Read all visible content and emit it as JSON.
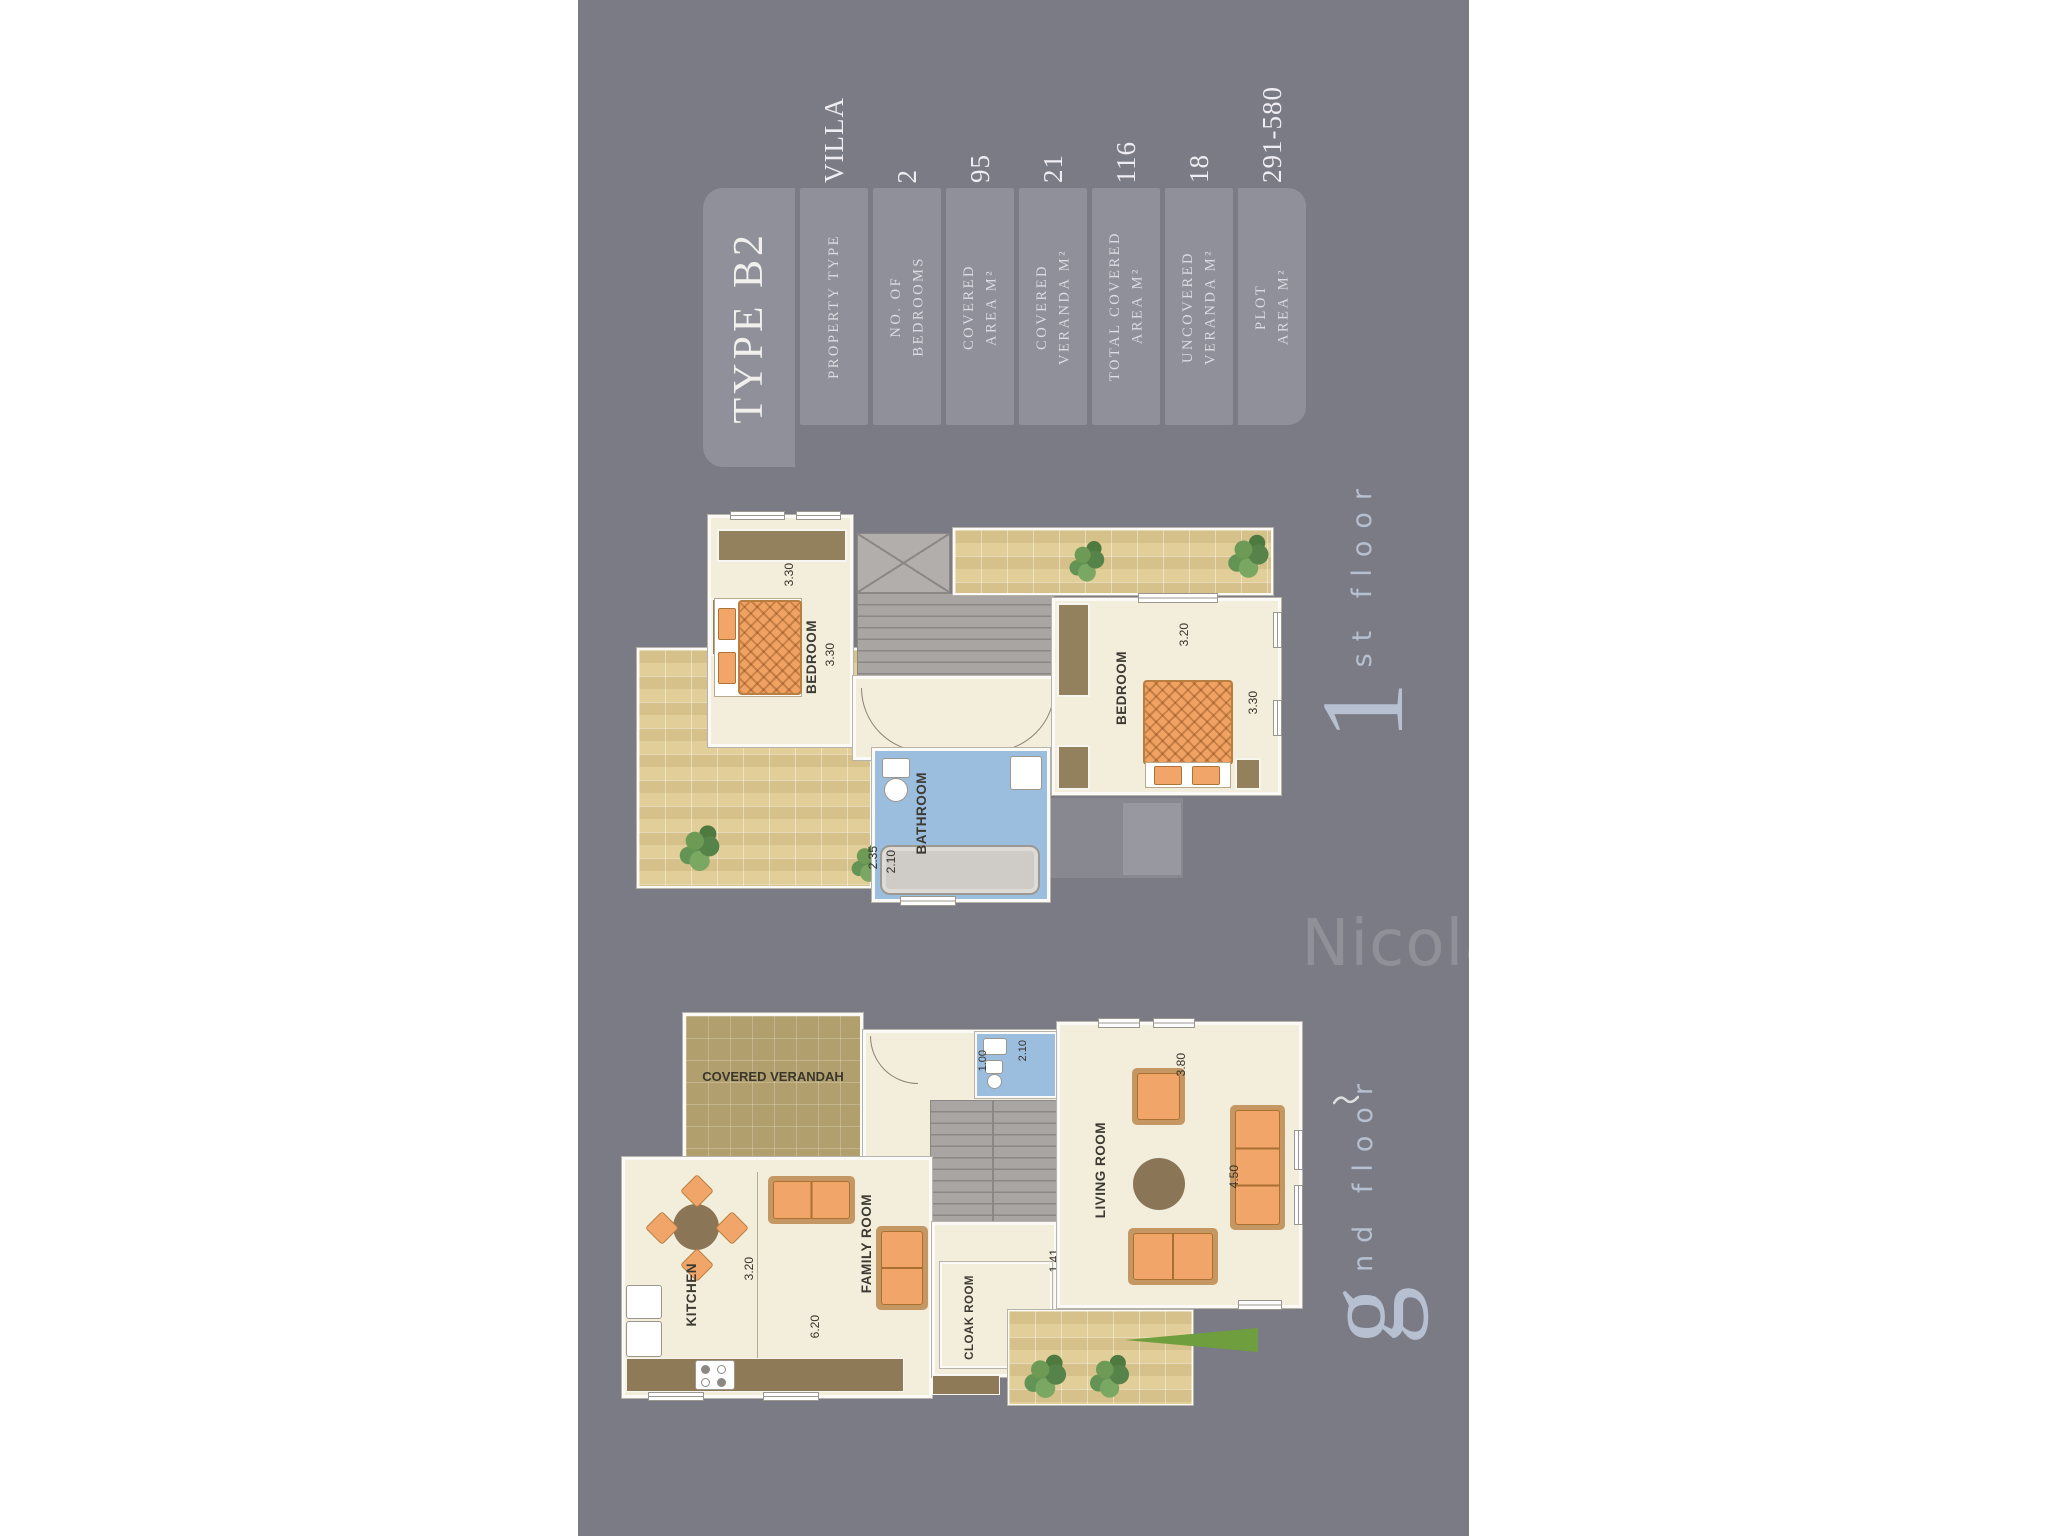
{
  "page": {
    "background": "#ffffff",
    "panel_color": "#7b7b85"
  },
  "spec_table": {
    "title": "TYPE B2",
    "rows": [
      {
        "label": "PROPERTY TYPE",
        "value": "VILLA"
      },
      {
        "label": "NO. OF\nBEDROOMS",
        "value": "2"
      },
      {
        "label": "COVERED\nAREA M²",
        "value": "95"
      },
      {
        "label": "COVERED\nVERANDA M²",
        "value": "21"
      },
      {
        "label": "TOTAL COVERED\nAREA M²",
        "value": "116"
      },
      {
        "label": "UNCOVERED\nVERANDA M²",
        "value": "18"
      },
      {
        "label": "PLOT\nAREA M²",
        "value": "291-580"
      }
    ]
  },
  "first_floor": {
    "floor_big": "1",
    "floor_small": "st floor",
    "rooms": {
      "bedroom_left": "BEDROOM",
      "bedroom_right": "BEDROOM",
      "bathroom": "BATHROOM"
    },
    "dims": {
      "bedroom_left_w": "3.30",
      "bedroom_left_d": "3.30",
      "bedroom_right_w": "3.20",
      "bedroom_right_d": "3.30",
      "bathroom_w": "2.35",
      "bathroom_d": "2.10"
    }
  },
  "ground_floor": {
    "floor_big": "g",
    "floor_small": "nd floor",
    "rooms": {
      "covered_verandah": "COVERED VERANDAH",
      "kitchen": "KITCHEN",
      "family_room": "FAMILY ROOM",
      "cloak_room": "CLOAK ROOM",
      "living_room": "LIVING ROOM"
    },
    "dims": {
      "kitchen_w": "3.20",
      "kitchen_l": "6.20",
      "hall": "1.41",
      "living_w": "3.80",
      "living_l": "4.50",
      "wc_d": "2.10",
      "wc_w": "1.00"
    }
  },
  "watermark": {
    "brand": "Nicolaou Estates"
  }
}
